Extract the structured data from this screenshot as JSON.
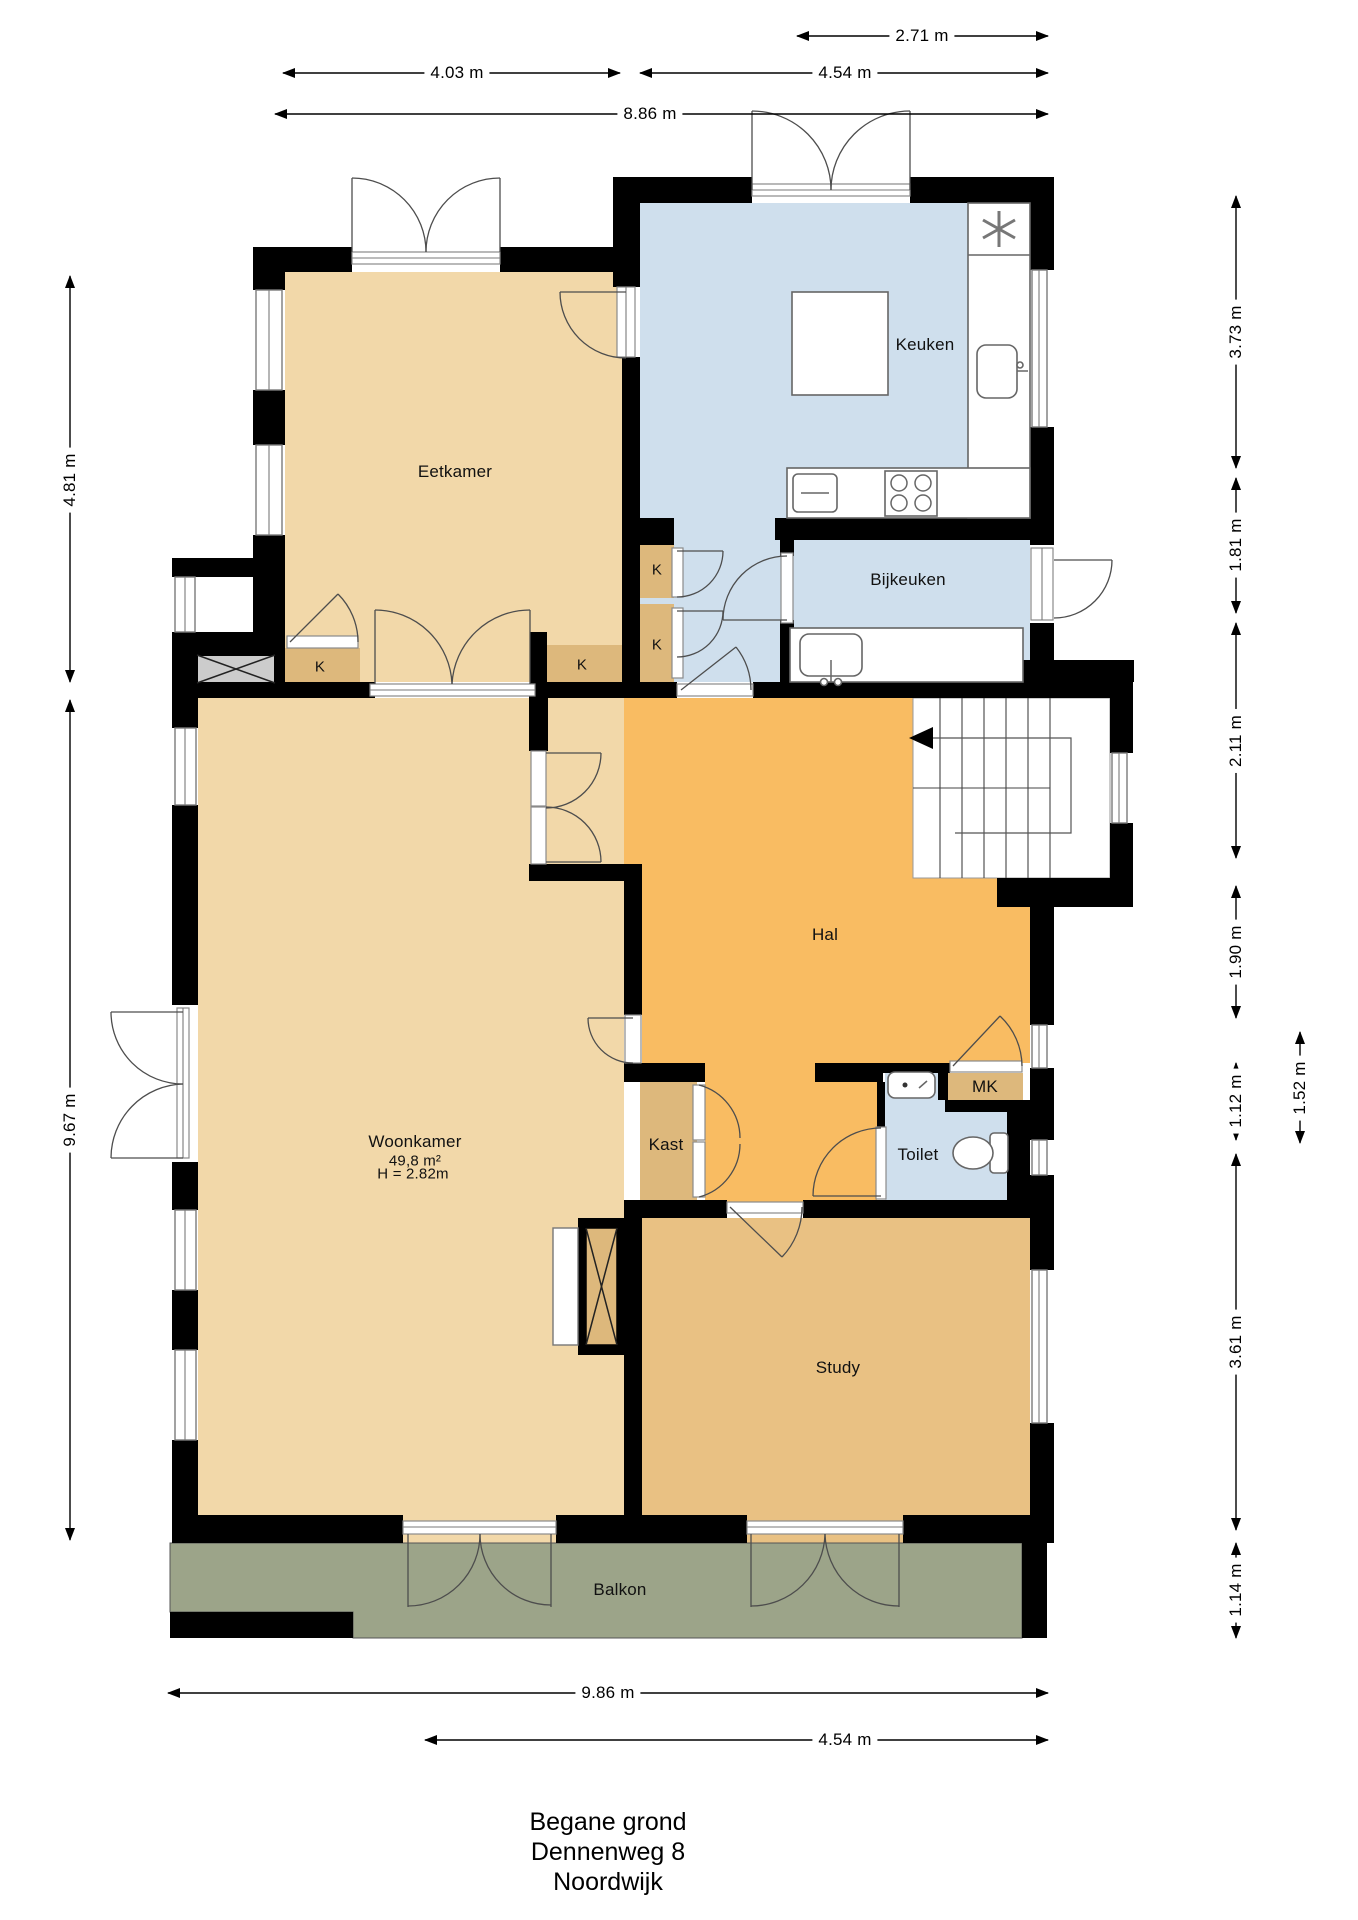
{
  "plan": {
    "rooms": {
      "eetkamer": {
        "label": "Eetkamer"
      },
      "keuken": {
        "label": "Keuken"
      },
      "bijkeuken": {
        "label": "Bijkeuken"
      },
      "hal": {
        "label": "Hal"
      },
      "woonkamer": {
        "label": "Woonkamer",
        "area": "49,8 m²",
        "height": "H = 2.82m"
      },
      "kast": {
        "label": "Kast"
      },
      "toilet": {
        "label": "Toilet"
      },
      "mk": {
        "label": "MK"
      },
      "study": {
        "label": "Study"
      },
      "balkon": {
        "label": "Balkon"
      },
      "closet_k": {
        "label": "K"
      }
    },
    "dimensions": {
      "top": [
        {
          "label": "2.71 m"
        },
        {
          "label": "4.03 m"
        },
        {
          "label": "4.54 m"
        },
        {
          "label": "8.86 m"
        }
      ],
      "left": [
        {
          "label": "4.81 m"
        },
        {
          "label": "9.67 m"
        }
      ],
      "right": [
        {
          "label": "3.73 m"
        },
        {
          "label": "1.81 m"
        },
        {
          "label": "2.11 m"
        },
        {
          "label": "1.90 m"
        },
        {
          "label": "1.12 m"
        },
        {
          "label": "1.52 m"
        },
        {
          "label": "3.61 m"
        },
        {
          "label": "1.14 m"
        }
      ],
      "bottom": [
        {
          "label": "9.86 m"
        },
        {
          "label": "4.54 m"
        }
      ]
    },
    "title": {
      "line1": "Begane grond",
      "line2": "Dennenweg 8",
      "line3": "Noordwijk"
    },
    "colors": {
      "wall": "#000000",
      "room_tan": "#f2d8a9",
      "room_orange": "#f9bc62",
      "room_blue": "#cfdfed",
      "room_study": "#e9c183",
      "closet_tan": "#ddb87c",
      "balkon_gray": "#9ca489",
      "hatch_gray": "#cccccc"
    }
  }
}
